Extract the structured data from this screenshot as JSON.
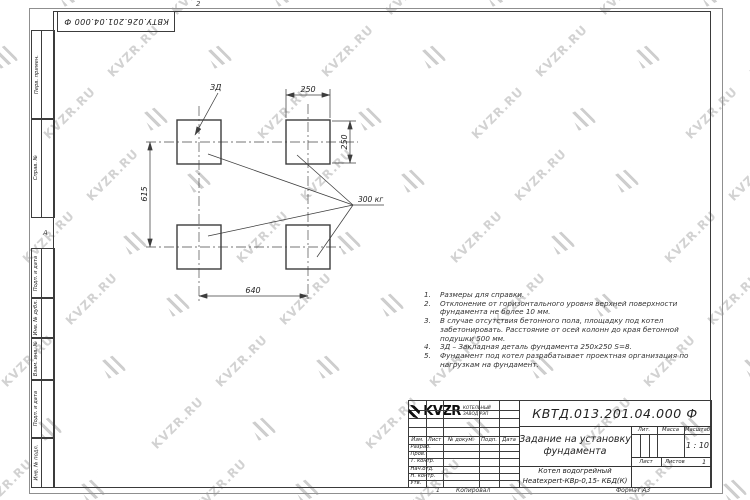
{
  "watermark": {
    "text": "KVZR.RU"
  },
  "margins": {
    "top_designation": "КВТУ.026.201.04.000 Ф",
    "zone_top": "2",
    "zone_left": "А",
    "left_labels": [
      "Перв. примен.",
      "Справ. №",
      "Подп. и дата",
      "Инв. № дубл.",
      "Взам. инв. №",
      "Подп. и дата",
      "Инв. № подл."
    ]
  },
  "drawing": {
    "dim_top": "250",
    "dim_right": "250",
    "dim_left": "615",
    "dim_bottom": "640",
    "label_embed": "ЗД",
    "label_weight": "300 кг"
  },
  "notes": {
    "items": [
      {
        "num": "1.",
        "text": "Размеры для справки."
      },
      {
        "num": "2.",
        "text": "Отклонение от горизонтального уровня верхней поверхности\nфундамента не более 10 мм."
      },
      {
        "num": "3.",
        "text": "В случае отсутствия бетонного пола, площадку под котел\nзабетонировать. Расстояние от осей колонн до края бетонной\nподушки 500 мм."
      },
      {
        "num": "4.",
        "text": "ЗД – Закладная деталь фундамента 250х250 S=8."
      },
      {
        "num": "5.",
        "text": "Фундамент под котел разрабатывает проектная организация по\nнагрузкам на фундамент."
      }
    ]
  },
  "title_block": {
    "designation": "КВТД.013.201.04.000 Ф",
    "title": "Задание на установку\nфундамента",
    "product": "Котел водогрейный\nHeatexpert-КВр-0,15- КБД(К)",
    "cols": {
      "izm": "Изм.",
      "list": "Лист",
      "doc": "№ докум.",
      "podp": "Подп.",
      "data": "Дата"
    },
    "rows": {
      "razrab": "Разраб.",
      "prov": "Пров.",
      "tkontr": "Т. контр.",
      "nachotd": "Нач.отд.",
      "nkontr": "Н. контр.",
      "utv": "Утв."
    },
    "lit": "Лит.",
    "massa": "Масса",
    "masshtab": "Масштаб",
    "scale": "1 : 10",
    "list_label": "Лист",
    "listov_label": "Листов",
    "listov_value": "1",
    "logo_text": "KVZR",
    "logo_sub": "КОТЕЛЬНЫЙ\nЗАВОД РЭП"
  },
  "footer": {
    "sheet": "1",
    "copied": "Копировал",
    "format": "Формат А3"
  }
}
